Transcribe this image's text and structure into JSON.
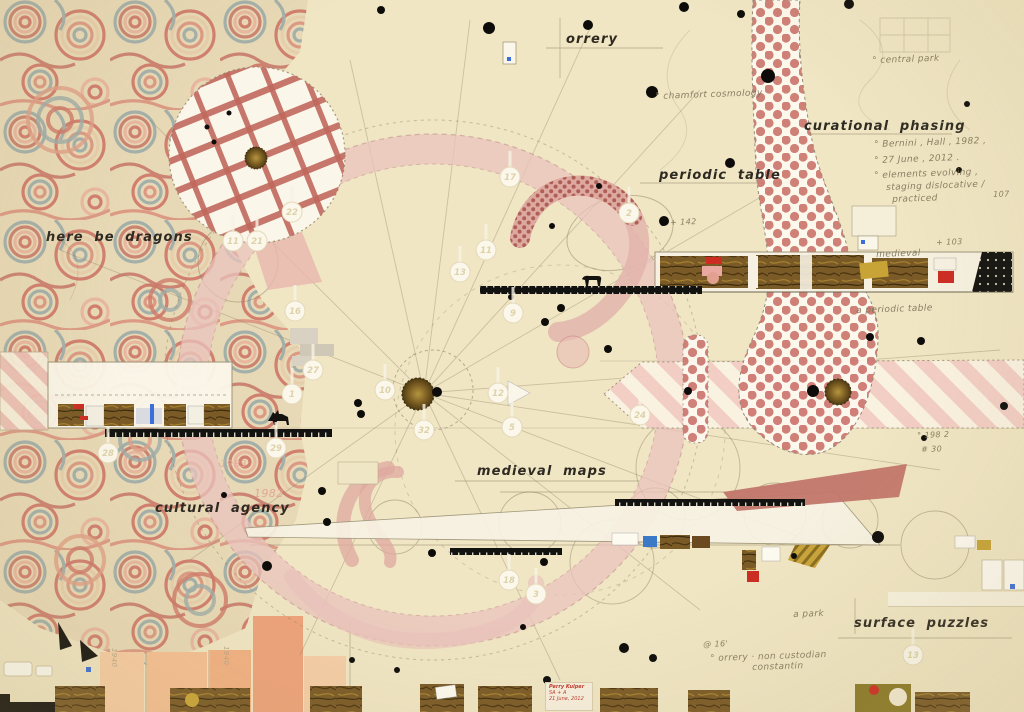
{
  "canvas": {
    "width": 1024,
    "height": 712,
    "paper_color": "#f0e6c4"
  },
  "labels": {
    "orrery": "orrery",
    "curational_phasing": "curational phasing",
    "periodic_table": "periodic table",
    "here_be_dragons": "here be dragons",
    "medieval_maps": "medieval maps",
    "cultural_agency": "cultural agency",
    "surface_puzzles": "surface puzzles"
  },
  "signature": {
    "artist": "Perry Kulper",
    "edition": "SA + A",
    "date": "21 June, 2012"
  },
  "annotations": [
    {
      "text": "° central park",
      "x": 872,
      "y": 56
    },
    {
      "text": "° chamfort cosmology",
      "x": 655,
      "y": 92
    },
    {
      "text": "° Bernini , Hall , 1982 ,",
      "x": 874,
      "y": 140
    },
    {
      "text": "° 27 June , 2012 .",
      "x": 874,
      "y": 156
    },
    {
      "text": "° elements evolving ,",
      "x": 874,
      "y": 171
    },
    {
      "text": "staging dislocative /",
      "x": 886,
      "y": 183
    },
    {
      "text": "practiced",
      "x": 892,
      "y": 195
    },
    {
      "text": "107",
      "x": 993,
      "y": 190,
      "size": 8
    },
    {
      "text": "+ 103",
      "x": 936,
      "y": 238,
      "size": 8
    },
    {
      "text": "a periodic table",
      "x": 856,
      "y": 306
    },
    {
      "text": "+ 142",
      "x": 670,
      "y": 218,
      "size": 8
    },
    {
      "text": "medieval",
      "x": 876,
      "y": 250
    },
    {
      "text": "° 198 2",
      "x": 917,
      "y": 431,
      "size": 8
    },
    {
      "text": "# 30",
      "x": 921,
      "y": 445,
      "size": 8
    },
    {
      "text": "a park",
      "x": 793,
      "y": 610
    },
    {
      "text": "@ 16'",
      "x": 703,
      "y": 640,
      "size": 8
    },
    {
      "text": "° orrery · non custodian",
      "x": 710,
      "y": 654
    },
    {
      "text": "constantin",
      "x": 752,
      "y": 663
    },
    {
      "text": "1982",
      "x": 254,
      "y": 487,
      "size": 11,
      "color": "#dfa191",
      "rot": 0
    },
    {
      "text": "1983",
      "x": 220,
      "y": 459,
      "size": 10,
      "color": "#e3ab9d",
      "rot": 0
    },
    {
      "text": "1940",
      "x": 118,
      "y": 648,
      "size": 7,
      "color": "#b3a585",
      "rot": 90
    },
    {
      "text": "1940",
      "x": 230,
      "y": 646,
      "size": 7,
      "color": "#b3a585",
      "rot": 90
    }
  ],
  "badges": [
    {
      "n": "22",
      "x": 292,
      "y": 212
    },
    {
      "n": "17",
      "x": 510,
      "y": 177
    },
    {
      "n": "2",
      "x": 629,
      "y": 213
    },
    {
      "n": "11",
      "x": 486,
      "y": 250
    },
    {
      "n": "13",
      "x": 460,
      "y": 272
    },
    {
      "n": "16",
      "x": 295,
      "y": 311
    },
    {
      "n": "9",
      "x": 513,
      "y": 313
    },
    {
      "n": "10",
      "x": 385,
      "y": 390
    },
    {
      "n": "12",
      "x": 498,
      "y": 393
    },
    {
      "n": "5",
      "x": 512,
      "y": 427
    },
    {
      "n": "32",
      "x": 424,
      "y": 430
    },
    {
      "n": "24",
      "x": 640,
      "y": 415
    },
    {
      "n": "27",
      "x": 313,
      "y": 370
    },
    {
      "n": "1",
      "x": 292,
      "y": 394
    },
    {
      "n": "28",
      "x": 108,
      "y": 453
    },
    {
      "n": "29",
      "x": 276,
      "y": 448
    },
    {
      "n": "11",
      "x": 233,
      "y": 241
    },
    {
      "n": "21",
      "x": 257,
      "y": 241
    },
    {
      "n": "18",
      "x": 509,
      "y": 580
    },
    {
      "n": "3",
      "x": 536,
      "y": 594
    },
    {
      "n": "13",
      "x": 913,
      "y": 655
    }
  ],
  "dots": [
    [
      381,
      10,
      4
    ],
    [
      489,
      28,
      6
    ],
    [
      588,
      25,
      5
    ],
    [
      684,
      7,
      5
    ],
    [
      741,
      14,
      4
    ],
    [
      849,
      4,
      5
    ],
    [
      768,
      76,
      7
    ],
    [
      652,
      92,
      6
    ],
    [
      730,
      163,
      5
    ],
    [
      664,
      221,
      5
    ],
    [
      552,
      226,
      3
    ],
    [
      663,
      223,
      3
    ],
    [
      599,
      186,
      3
    ],
    [
      561,
      308,
      4
    ],
    [
      545,
      322,
      4
    ],
    [
      511,
      297,
      3
    ],
    [
      358,
      403,
      4
    ],
    [
      361,
      414,
      4
    ],
    [
      688,
      391,
      4
    ],
    [
      813,
      391,
      6
    ],
    [
      921,
      341,
      4
    ],
    [
      870,
      337,
      4
    ],
    [
      608,
      349,
      4
    ],
    [
      1004,
      406,
      4
    ],
    [
      924,
      438,
      3
    ],
    [
      322,
      491,
      4
    ],
    [
      224,
      495,
      3
    ],
    [
      327,
      522,
      4
    ],
    [
      267,
      566,
      5
    ],
    [
      432,
      553,
      4
    ],
    [
      544,
      562,
      4
    ],
    [
      878,
      537,
      6
    ],
    [
      794,
      556,
      3
    ],
    [
      523,
      627,
      3
    ],
    [
      624,
      648,
      5
    ],
    [
      653,
      658,
      4
    ],
    [
      547,
      680,
      4
    ],
    [
      959,
      170,
      3
    ],
    [
      967,
      104,
      3
    ],
    [
      229,
      113,
      2.5
    ],
    [
      207,
      127,
      2.5
    ],
    [
      214,
      142,
      2.5
    ],
    [
      437,
      392,
      5
    ],
    [
      352,
      660,
      3
    ],
    [
      397,
      670,
      3
    ]
  ],
  "palette": {
    "paper": "#f0e6c4",
    "marble_red": "#cf7a69",
    "marble_gray": "#9fada9",
    "ring_pink": "#e9c3bc",
    "polka_red": "#c4625a",
    "stripe_pink": "#f3cdc5",
    "rust_wedge": "#c2766b",
    "straw": "#7a5a26",
    "ink": "#2e2a22",
    "pencil": "#8d8264",
    "badge_fill": "#fbf7eb",
    "accent_blue": "#3a6fd8",
    "accent_red": "#cc2c22",
    "gold": "#c8a437"
  }
}
